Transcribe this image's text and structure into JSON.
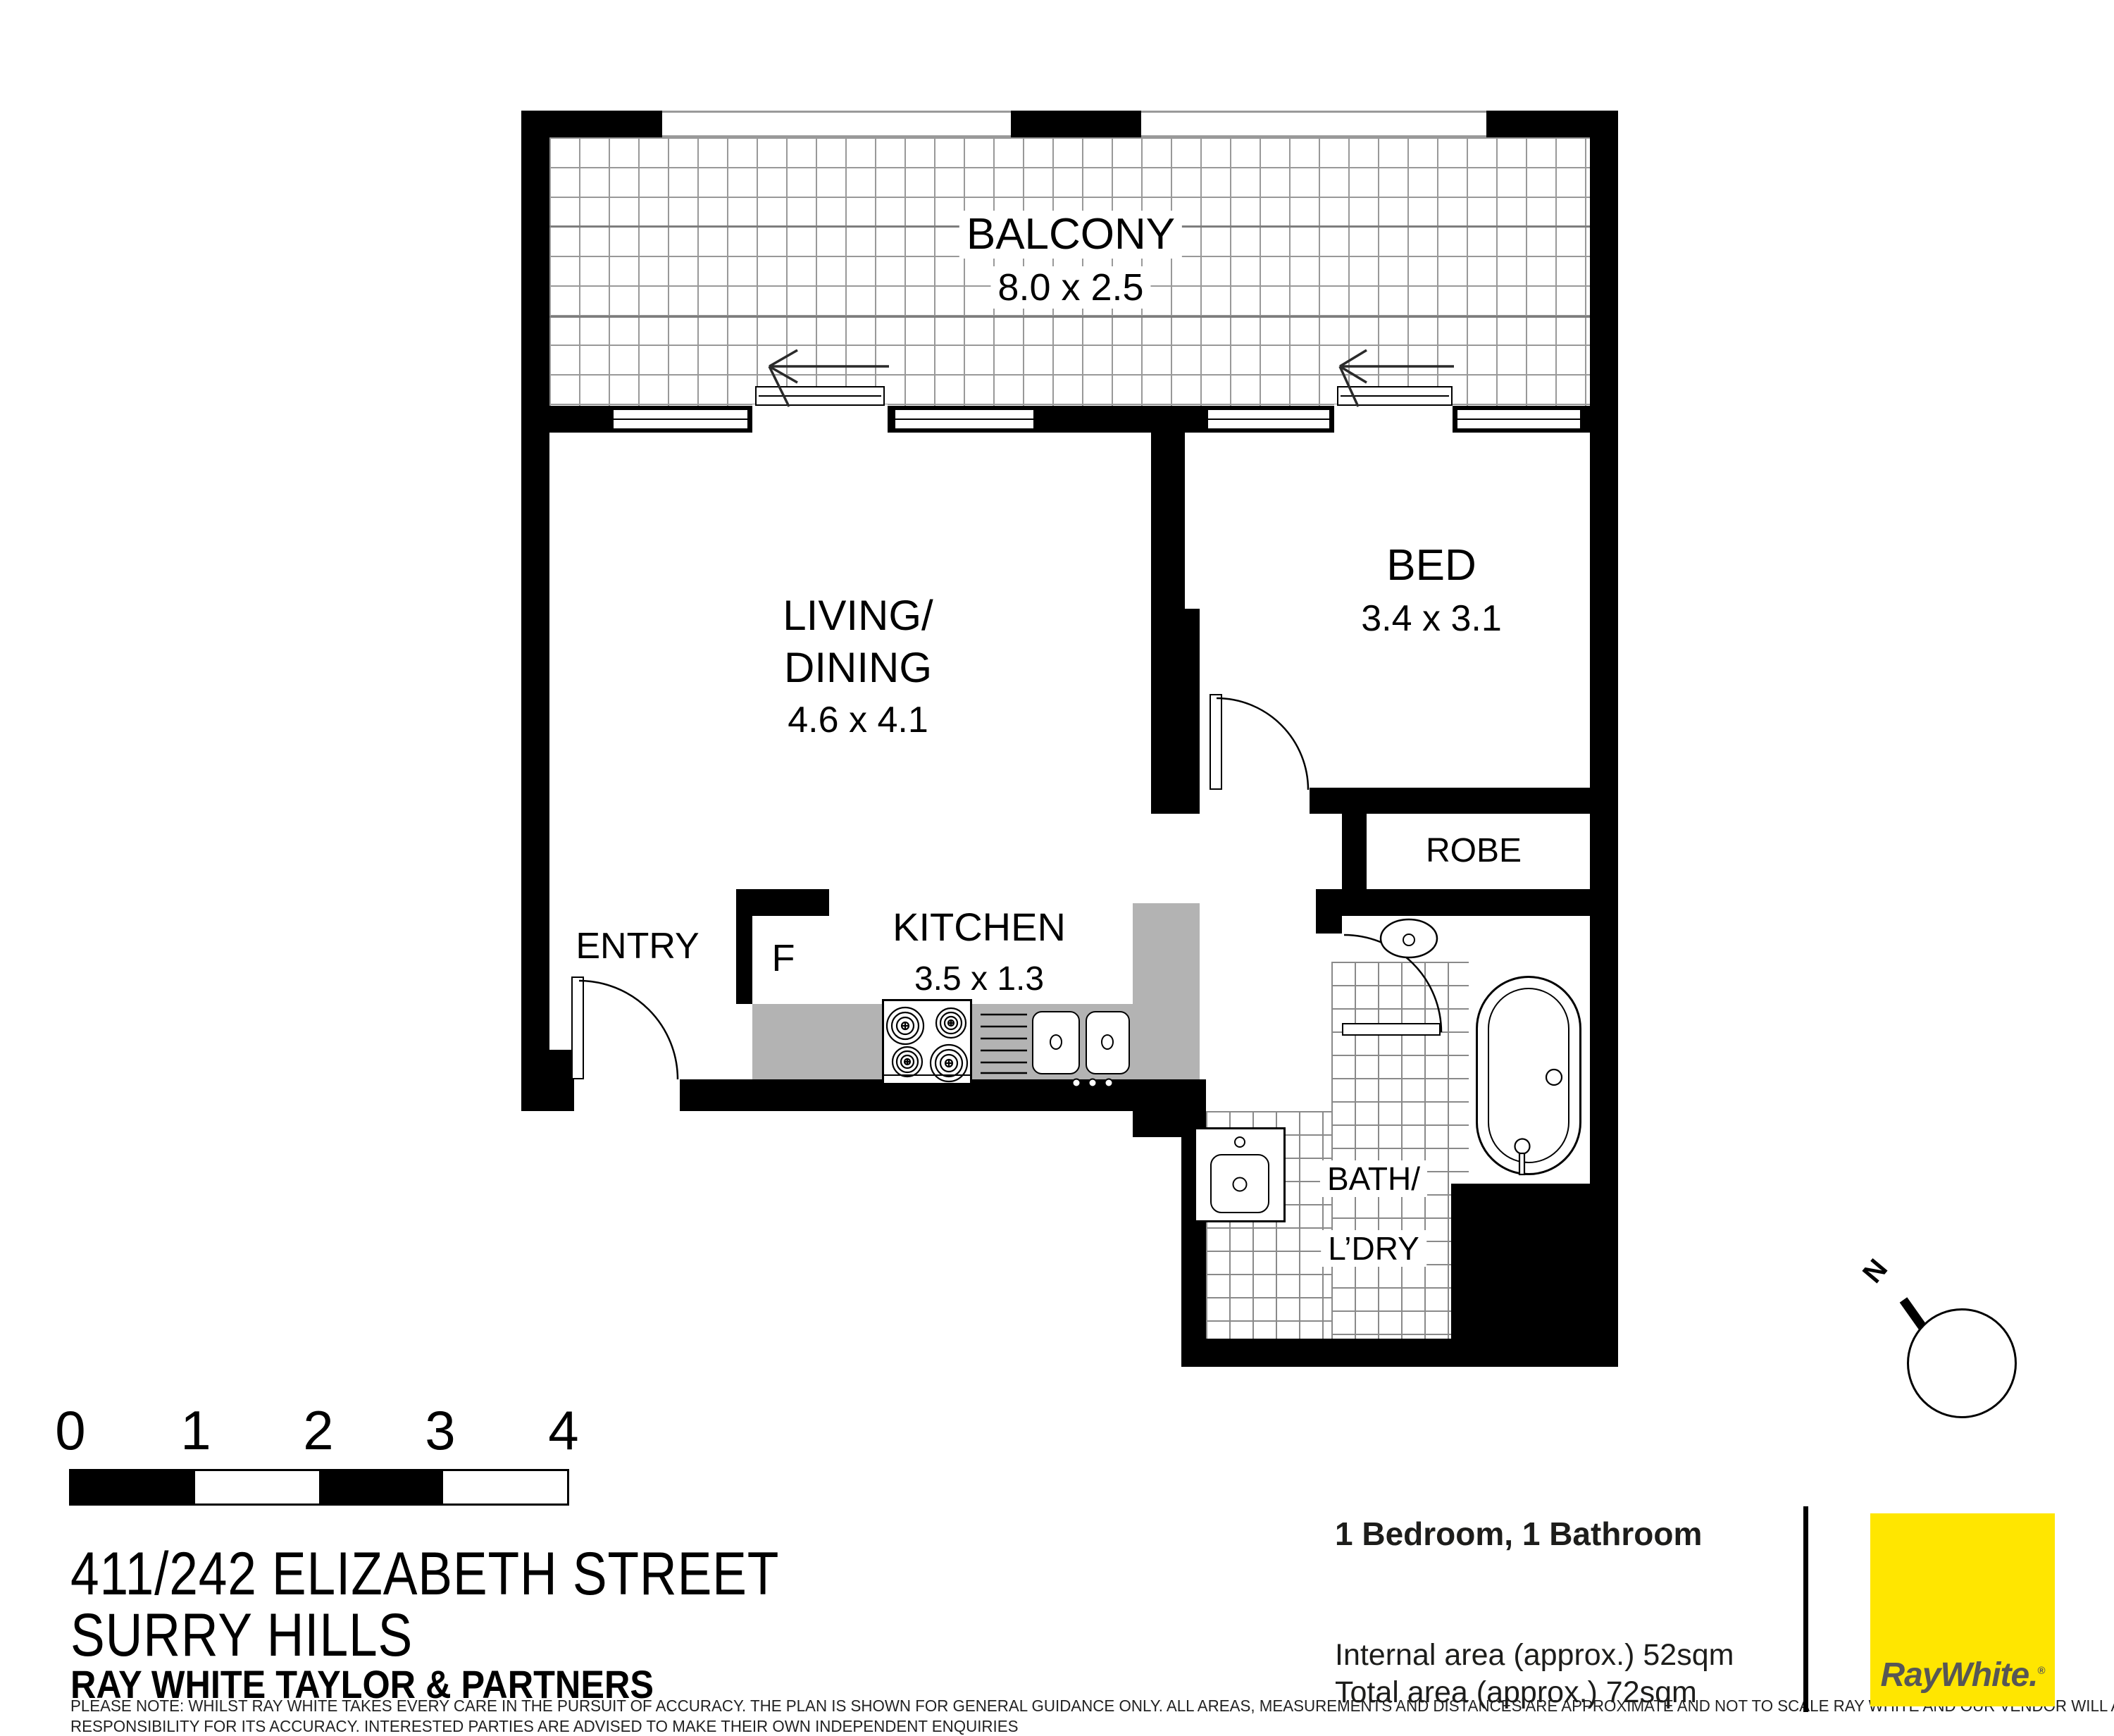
{
  "plan": {
    "rooms": {
      "balcony": {
        "name": "BALCONY",
        "dims": "8.0 x 2.5"
      },
      "living": {
        "name_line1": "LIVING/",
        "name_line2": "DINING",
        "dims": "4.6 x 4.1"
      },
      "bed": {
        "name": "BED",
        "dims": "3.4 x 3.1"
      },
      "robe": {
        "name": "ROBE"
      },
      "kitchen": {
        "name": "KITCHEN",
        "dims": "3.5 x 1.3"
      },
      "entry": {
        "name": "ENTRY"
      },
      "fridge": {
        "label": "F"
      },
      "bath": {
        "name_line1": "BATH/",
        "name_line2": "L’DRY"
      }
    },
    "compass": {
      "north_label": "N"
    }
  },
  "scale_bar": {
    "ticks": [
      "0",
      "1",
      "2",
      "3",
      "4"
    ]
  },
  "footer": {
    "address_line1": "411/242 ELIZABETH STREET",
    "address_line2": "SURRY HILLS",
    "agency": "RAY WHITE TAYLOR & PARTNERS",
    "summary": "1 Bedroom, 1 Bathroom",
    "internal_area": "Internal area (approx.) 52sqm",
    "total_area": "Total area (approx.) 72sqm",
    "disclaimer_line1": "PLEASE NOTE: WHILST RAY WHITE TAKES EVERY CARE IN THE PURSUIT OF ACCURACY. THE PLAN IS SHOWN FOR GENERAL GUIDANCE ONLY. ALL AREAS, MEASUREMENTS AND DISTANCES ARE APPROXIMATE AND NOT TO SCALE RAY WHITE AND OUR VENDOR WILL ACCEPT NO",
    "disclaimer_line2": "RESPONSIBILITY FOR ITS ACCURACY. INTERESTED PARTIES ARE ADVISED TO MAKE THEIR OWN INDEPENDENT ENQUIRIES",
    "logo_text": "RayWhite",
    "logo_suffix": ".",
    "logo_reg": "®"
  },
  "colors": {
    "accent_yellow": "#FFE600",
    "counter_gray": "#b3b3b3",
    "logo_gray": "#575756"
  }
}
